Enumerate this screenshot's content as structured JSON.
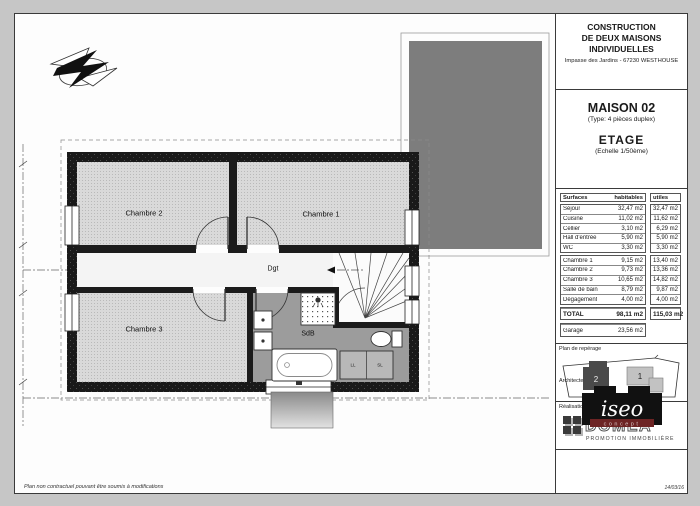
{
  "page": {
    "footer_note": "Plan non contractuel pouvant être soumis à modifications",
    "date": "14/03/16"
  },
  "title_block": {
    "header": {
      "line1": "CONSTRUCTION",
      "line2": "DE DEUX MAISONS",
      "line3": "INDIVIDUELLES",
      "address": "Impasse des Jardins - 67230 WESTHOUSE"
    },
    "project": {
      "title": "MAISON 02",
      "subtitle": "(Type: 4 pièces duplex)",
      "level": "ETAGE",
      "scale": "(Echelle 1/50ème)"
    },
    "surfaces_table": {
      "col_headers": {
        "name": "Surfaces",
        "habitables": "habitables",
        "utiles": "utiles"
      },
      "rows_group1": [
        {
          "label": "Séjour",
          "habitable": "32,47 m2",
          "utile": "32,47 m2"
        },
        {
          "label": "Cuisine",
          "habitable": "11,02 m2",
          "utile": "11,62 m2"
        },
        {
          "label": "Cellier",
          "habitable": "3,10 m2",
          "utile": "6,29 m2"
        },
        {
          "label": "Hall d'entrée",
          "habitable": "5,90 m2",
          "utile": "5,90 m2"
        },
        {
          "label": "WC",
          "habitable": "3,30 m2",
          "utile": "3,30 m2"
        }
      ],
      "rows_group2": [
        {
          "label": "Chambre 1",
          "habitable": "9,15 m2",
          "utile": "13,40 m2"
        },
        {
          "label": "Chambre 2",
          "habitable": "9,73 m2",
          "utile": "13,36 m2"
        },
        {
          "label": "Chambre 3",
          "habitable": "10,65 m2",
          "utile": "14,82 m2"
        },
        {
          "label": "Salle de bain",
          "habitable": "8,79 m2",
          "utile": "9,87 m2"
        },
        {
          "label": "Dégagement",
          "habitable": "4,00 m2",
          "utile": "4,00 m2"
        }
      ],
      "total": {
        "label": "TOTAL",
        "habitable": "98,11 m2",
        "utile": "115,03 m2"
      },
      "garage": {
        "label": "Garage",
        "habitable": "23,56 m2"
      }
    },
    "sections": {
      "reperage_label": "Plan de repérage",
      "realisation_label": "Réalisation",
      "architecte_label": "Architecte"
    },
    "reperage": {
      "building1": "1",
      "building2": "2"
    },
    "realisation_logo": {
      "name": "DOMEA",
      "tagline": "PROMOTION IMMOBILIÈRE"
    },
    "architecte_logo": {
      "name": "iseo",
      "tagline": "concept"
    }
  },
  "plan": {
    "rooms": [
      {
        "id": "chambre2",
        "label": "Chambre 2"
      },
      {
        "id": "chambre1",
        "label": "Chambre 1"
      },
      {
        "id": "chambre3",
        "label": "Chambre 3"
      },
      {
        "id": "dgt",
        "label": "Dgt"
      },
      {
        "id": "sdb",
        "label": "SdB"
      }
    ],
    "appliances": {
      "ll": "LL",
      "sl": "SL"
    }
  },
  "colors": {
    "paper": "#fdfdfd",
    "page_margin": "#c6c6c6",
    "wall": "#1b1b1b",
    "bedroom_floor": "#d9d9d9",
    "bath_floor": "#9c9c9c",
    "roof_overlay": "#7d7d7d",
    "logo_accent_maroon": "#6d2424"
  }
}
